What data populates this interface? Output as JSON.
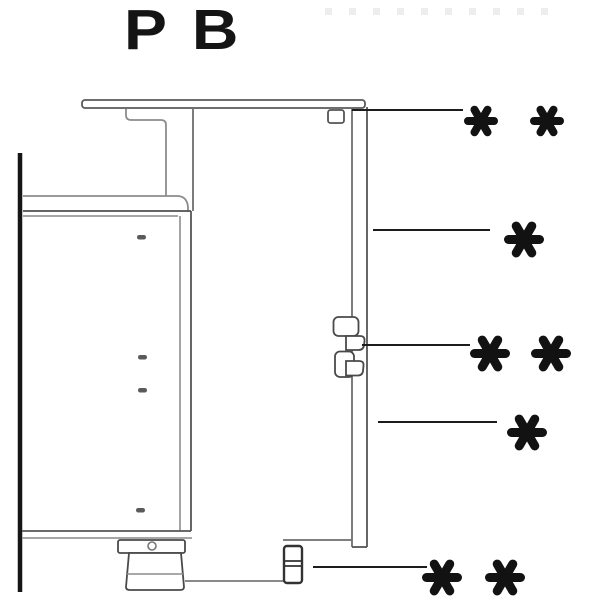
{
  "page": {
    "title": "PB"
  },
  "callouts": [
    {
      "id": "worktop-fixing-clip",
      "symbol": "**",
      "asterisks": 2
    },
    {
      "id": "side-panel-upper",
      "symbol": "*",
      "asterisks": 1
    },
    {
      "id": "suspension-bracket",
      "symbol": "**",
      "asterisks": 2
    },
    {
      "id": "side-panel-lower",
      "symbol": "*",
      "asterisks": 1
    },
    {
      "id": "panel-foot",
      "symbol": "**",
      "asterisks": 2
    }
  ],
  "colors": {
    "background": "#ffffff",
    "line_dark": "#161616",
    "line_medium": "#555555",
    "line_light": "#999999",
    "asterisk": "#121212"
  }
}
